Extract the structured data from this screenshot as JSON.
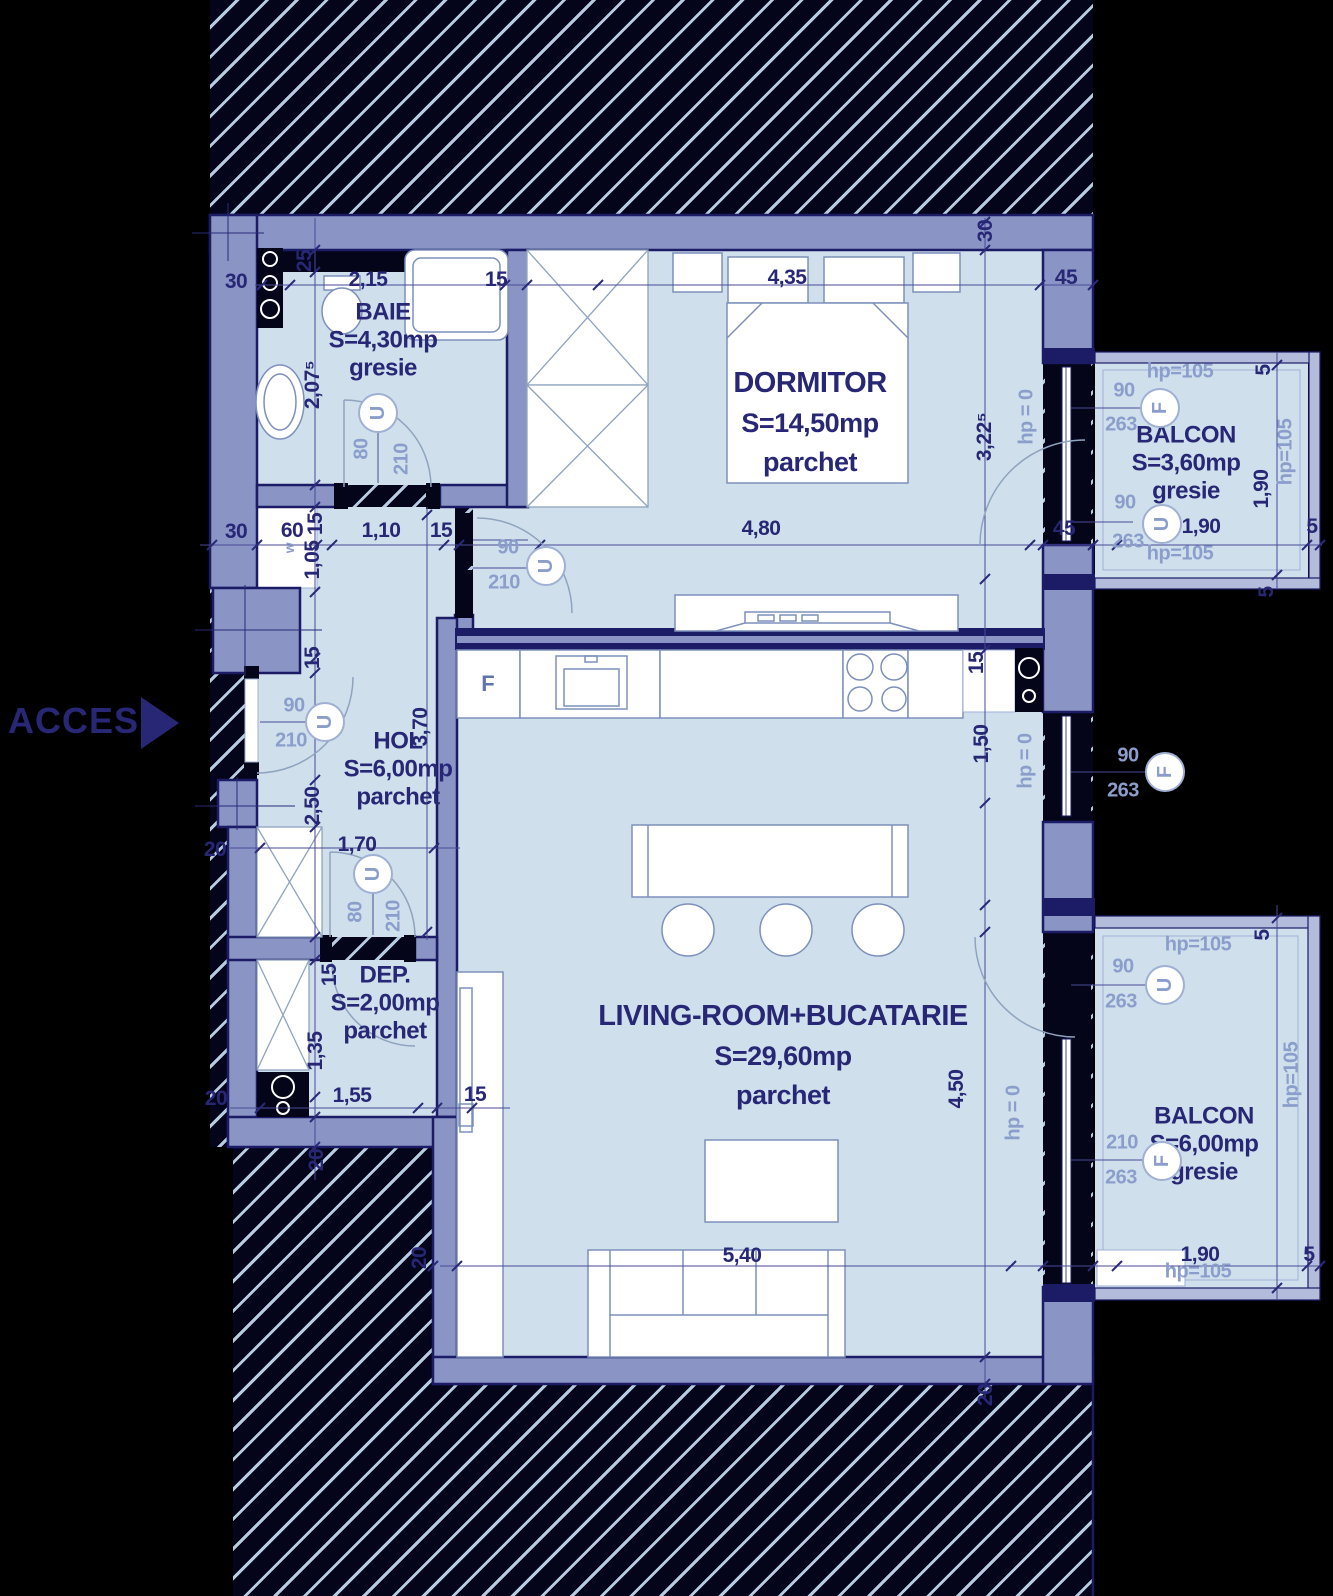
{
  "plan": {
    "access_label": "ACCES",
    "colors": {
      "wall": "#8a95c6",
      "outline": "#1b1b66",
      "floor": "#cfe0ec",
      "dim": "#272775",
      "light": "#8b9ecb",
      "hatch": "#b6cce0"
    },
    "rooms": [
      {
        "id": "baie",
        "name": "BAIE",
        "area": "S=4,30mp",
        "floor": "gresie",
        "x": 383,
        "y": 340,
        "cls": "sm"
      },
      {
        "id": "dormitor",
        "name": "DORMITOR",
        "area": "S=14,50mp",
        "floor": "parchet",
        "x": 810,
        "y": 422,
        "cls": "lg"
      },
      {
        "id": "hol",
        "name": "HOL",
        "area": "S=6,00mp",
        "floor": "parchet",
        "x": 398,
        "y": 769,
        "cls": "sm"
      },
      {
        "id": "dep",
        "name": "DEP.",
        "area": "S=2,00mp",
        "floor": "parchet",
        "x": 385,
        "y": 1003,
        "cls": "sm"
      },
      {
        "id": "living",
        "name": "LIVING-ROOM+BUCATARIE",
        "area": "S=29,60mp",
        "floor": "parchet",
        "x": 783,
        "y": 1055,
        "cls": "lg"
      },
      {
        "id": "balcon-sus",
        "name": "BALCON",
        "area": "S=3,60mp",
        "floor": "gresie",
        "x": 1186,
        "y": 463,
        "cls": "sm"
      },
      {
        "id": "balcon-jos",
        "name": "BALCON",
        "area": "S=6,00mp",
        "floor": "gresie",
        "x": 1204,
        "y": 1144,
        "cls": "sm"
      }
    ],
    "dim_labels": [
      {
        "t": "30",
        "x": 236,
        "y": 282
      },
      {
        "t": "2,15",
        "x": 368,
        "y": 280
      },
      {
        "t": "15",
        "x": 496,
        "y": 280
      },
      {
        "t": "4,35",
        "x": 787,
        "y": 278
      },
      {
        "t": "45",
        "x": 1066,
        "y": 278
      },
      {
        "t": "30",
        "x": 986,
        "y": 231,
        "r": 1
      },
      {
        "t": "25",
        "x": 305,
        "y": 261,
        "r": 1
      },
      {
        "t": "2,07⁵",
        "x": 313,
        "y": 385,
        "r": 1
      },
      {
        "t": "30",
        "x": 236,
        "y": 532
      },
      {
        "t": "60",
        "x": 292,
        "y": 531
      },
      {
        "t": "15",
        "x": 316,
        "y": 524,
        "r": 1
      },
      {
        "t": "1,10",
        "x": 381,
        "y": 531
      },
      {
        "t": "15",
        "x": 441,
        "y": 531
      },
      {
        "t": "4,80",
        "x": 761,
        "y": 529
      },
      {
        "t": "45",
        "x": 1064,
        "y": 529
      },
      {
        "t": "5",
        "x": 1312,
        "y": 527
      },
      {
        "t": "1,05",
        "x": 313,
        "y": 560,
        "r": 1
      },
      {
        "t": "15",
        "x": 313,
        "y": 658,
        "r": 1
      },
      {
        "t": "3,70",
        "x": 421,
        "y": 727,
        "r": 1
      },
      {
        "t": "2,50",
        "x": 313,
        "y": 806,
        "r": 1
      },
      {
        "t": "20",
        "x": 215,
        "y": 850
      },
      {
        "t": "1,70",
        "x": 357,
        "y": 845
      },
      {
        "t": "3,22⁵",
        "x": 985,
        "y": 437,
        "r": 1
      },
      {
        "t": "1,50",
        "x": 982,
        "y": 744,
        "r": 1
      },
      {
        "t": "15",
        "x": 977,
        "y": 663,
        "r": 1
      },
      {
        "t": "15",
        "x": 330,
        "y": 975,
        "r": 1
      },
      {
        "t": "1,35",
        "x": 316,
        "y": 1051,
        "r": 1
      },
      {
        "t": "20",
        "x": 216,
        "y": 1099
      },
      {
        "t": "1,55",
        "x": 352,
        "y": 1096
      },
      {
        "t": "15",
        "x": 475,
        "y": 1095
      },
      {
        "t": "20",
        "x": 317,
        "y": 1160,
        "r": 1
      },
      {
        "t": "4,50",
        "x": 957,
        "y": 1089,
        "r": 1
      },
      {
        "t": "5,40",
        "x": 742,
        "y": 1256
      },
      {
        "t": "20",
        "x": 420,
        "y": 1258,
        "r": 1
      },
      {
        "t": "20",
        "x": 986,
        "y": 1395,
        "r": 1
      },
      {
        "t": "1,90",
        "x": 1201,
        "y": 527
      },
      {
        "t": "1,90",
        "x": 1262,
        "y": 489,
        "r": 1
      },
      {
        "t": "5",
        "x": 1264,
        "y": 370,
        "r": 1
      },
      {
        "t": "5",
        "x": 1267,
        "y": 592,
        "r": 1
      },
      {
        "t": "1,90",
        "x": 1200,
        "y": 1255
      },
      {
        "t": "5",
        "x": 1309,
        "y": 1255
      },
      {
        "t": "5",
        "x": 1263,
        "y": 935,
        "r": 1
      }
    ],
    "opening_labels": [
      {
        "t": "80",
        "x": 362,
        "y": 449,
        "r": 1
      },
      {
        "t": "210",
        "x": 402,
        "y": 459,
        "r": 1
      },
      {
        "t": "90",
        "x": 294,
        "y": 706
      },
      {
        "t": "210",
        "x": 291,
        "y": 741
      },
      {
        "t": "90",
        "x": 508,
        "y": 548
      },
      {
        "t": "210",
        "x": 504,
        "y": 583
      },
      {
        "t": "80",
        "x": 356,
        "y": 912,
        "r": 1
      },
      {
        "t": "210",
        "x": 394,
        "y": 916,
        "r": 1
      },
      {
        "t": "hp = 0",
        "x": 1027,
        "y": 417,
        "r": 1
      },
      {
        "t": "hp = 0",
        "x": 1026,
        "y": 761,
        "r": 1
      },
      {
        "t": "hp = 0",
        "x": 1014,
        "y": 1113,
        "r": 1
      },
      {
        "t": "90",
        "x": 1124,
        "y": 391
      },
      {
        "t": "263",
        "x": 1121,
        "y": 425
      },
      {
        "t": "90",
        "x": 1125,
        "y": 503
      },
      {
        "t": "263",
        "x": 1128,
        "y": 542
      },
      {
        "t": "hp=105",
        "x": 1180,
        "y": 372
      },
      {
        "t": "hp=105",
        "x": 1286,
        "y": 452,
        "r": 1
      },
      {
        "t": "hp=105",
        "x": 1180,
        "y": 554
      },
      {
        "t": "90",
        "x": 1128,
        "y": 756
      },
      {
        "t": "263",
        "x": 1123,
        "y": 791
      },
      {
        "t": "90",
        "x": 1123,
        "y": 967
      },
      {
        "t": "263",
        "x": 1121,
        "y": 1002
      },
      {
        "t": "210",
        "x": 1122,
        "y": 1143
      },
      {
        "t": "263",
        "x": 1121,
        "y": 1178
      },
      {
        "t": "hp=105",
        "x": 1198,
        "y": 945
      },
      {
        "t": "hp=105",
        "x": 1292,
        "y": 1075,
        "r": 1
      },
      {
        "t": "hp=105",
        "x": 1198,
        "y": 1272
      },
      {
        "t": "w",
        "x": 289,
        "y": 548,
        "r": 1,
        "s": 1
      }
    ],
    "markers": [
      {
        "t": "U",
        "x": 378,
        "y": 413,
        "k": "door"
      },
      {
        "t": "U",
        "x": 325,
        "y": 722,
        "k": "door"
      },
      {
        "t": "U",
        "x": 546,
        "y": 566,
        "k": "door"
      },
      {
        "t": "U",
        "x": 373,
        "y": 874,
        "k": "door"
      },
      {
        "t": "F",
        "x": 1160,
        "y": 408,
        "k": "window"
      },
      {
        "t": "U",
        "x": 1162,
        "y": 524,
        "k": "door"
      },
      {
        "t": "F",
        "x": 1165,
        "y": 772,
        "k": "window"
      },
      {
        "t": "U",
        "x": 1165,
        "y": 985,
        "k": "door"
      },
      {
        "t": "F",
        "x": 1162,
        "y": 1161,
        "k": "window"
      }
    ],
    "fixtures": {
      "fridge_label": "F",
      "fridge_x": 488,
      "fridge_y": 684
    }
  }
}
